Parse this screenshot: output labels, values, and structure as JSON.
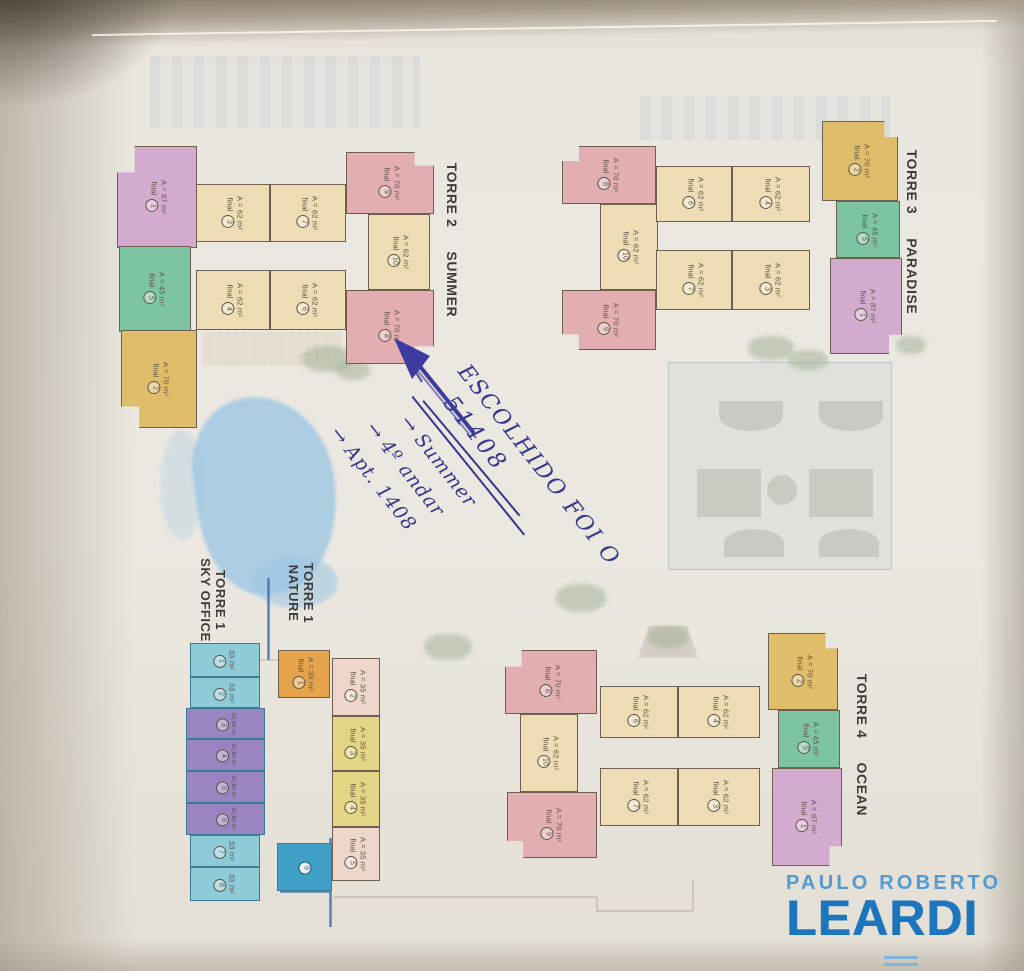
{
  "plan": {
    "unit_final_word": "final",
    "towers": [
      {
        "id": "torre-2",
        "label": "TORRE 2",
        "name": "SUMMER",
        "label_pos": {
          "cx": 452,
          "cy": 240,
          "stack": false
        },
        "units": [
          {
            "final": "1",
            "area": "A = 87 m²",
            "type": "purple",
            "x": 117,
            "y": 146,
            "w": 80,
            "h": 102,
            "clip": "polygon(22% 0,100% 0,100% 100%,0 100%,0 26%,22% 26%)"
          },
          {
            "final": "5",
            "area": "A = 45 m²",
            "type": "green",
            "x": 119,
            "y": 246,
            "w": 72,
            "h": 86
          },
          {
            "final": "2",
            "area": "A = 70 m²",
            "type": "yellow",
            "x": 121,
            "y": 330,
            "w": 76,
            "h": 98,
            "clip": "polygon(0 0,100% 0,100% 100%,24% 100%,24% 78%,0 78%)"
          },
          {
            "final": "3",
            "area": "A = 62 m²",
            "type": "tan",
            "x": 196,
            "y": 184,
            "w": 74,
            "h": 58
          },
          {
            "final": "7",
            "area": "A = 62 m²",
            "type": "tan",
            "x": 270,
            "y": 184,
            "w": 76,
            "h": 58
          },
          {
            "final": "4",
            "area": "A = 62 m²",
            "type": "tan",
            "x": 196,
            "y": 270,
            "w": 74,
            "h": 60
          },
          {
            "final": "6",
            "area": "A = 62 m²",
            "type": "tan",
            "x": 270,
            "y": 270,
            "w": 76,
            "h": 60
          },
          {
            "final": "9",
            "area": "A = 70 m²",
            "type": "pink",
            "x": 346,
            "y": 152,
            "w": 88,
            "h": 62,
            "clip": "polygon(0 0,78% 0,78% 22%,100% 22%,100% 100%,0 100%)"
          },
          {
            "final": "10",
            "area": "A = 62 m²",
            "type": "tan",
            "x": 368,
            "y": 214,
            "w": 62,
            "h": 76
          },
          {
            "final": "8",
            "area": "A = 70 m²",
            "type": "pink",
            "x": 346,
            "y": 290,
            "w": 88,
            "h": 74,
            "clip": "polygon(0 0,100% 0,100% 76%,78% 76%,78% 100%,0 100%)"
          }
        ]
      },
      {
        "id": "torre-3",
        "label": "TORRE 3",
        "name": "PARADISE",
        "label_pos": {
          "cx": 912,
          "cy": 232,
          "stack": false
        },
        "units": [
          {
            "final": "8",
            "area": "A = 70 m²",
            "type": "pink",
            "x": 562,
            "y": 146,
            "w": 94,
            "h": 58,
            "clip": "polygon(18% 0,100% 0,100% 100%,0 100%,0 26%,18% 26%)"
          },
          {
            "final": "10",
            "area": "A = 62 m²",
            "type": "tan",
            "x": 600,
            "y": 204,
            "w": 58,
            "h": 86
          },
          {
            "final": "9",
            "area": "A = 70 m²",
            "type": "pink",
            "x": 562,
            "y": 290,
            "w": 94,
            "h": 60,
            "clip": "polygon(0 0,100% 0,100% 100%,18% 100%,18% 74%,0 74%)"
          },
          {
            "final": "6",
            "area": "A = 62 m²",
            "type": "tan",
            "x": 656,
            "y": 166,
            "w": 76,
            "h": 56
          },
          {
            "final": "4",
            "area": "A = 62 m²",
            "type": "tan",
            "x": 732,
            "y": 166,
            "w": 78,
            "h": 56
          },
          {
            "final": "7",
            "area": "A = 62 m²",
            "type": "tan",
            "x": 656,
            "y": 250,
            "w": 76,
            "h": 60
          },
          {
            "final": "3",
            "area": "A = 62 m²",
            "type": "tan",
            "x": 732,
            "y": 250,
            "w": 78,
            "h": 60
          },
          {
            "final": "2",
            "area": "A = 70 m²",
            "type": "yellow",
            "x": 822,
            "y": 121,
            "w": 76,
            "h": 80,
            "clip": "polygon(0 0,82% 0,82% 20%,100% 20%,100% 100%,0 100%)"
          },
          {
            "final": "5",
            "area": "A = 45 m²",
            "type": "green",
            "x": 836,
            "y": 201,
            "w": 64,
            "h": 57
          },
          {
            "final": "1",
            "area": "A = 87 m²",
            "type": "purple",
            "x": 830,
            "y": 258,
            "w": 72,
            "h": 96,
            "clip": "polygon(0 0,100% 0,100% 80%,82% 80%,82% 100%,0 100%)"
          }
        ]
      },
      {
        "id": "torre-4",
        "label": "TORRE 4",
        "name": "OCEAN",
        "label_pos": {
          "cx": 862,
          "cy": 745,
          "stack": false
        },
        "units": [
          {
            "final": "8",
            "area": "A = 70 m²",
            "type": "pink",
            "x": 505,
            "y": 650,
            "w": 92,
            "h": 64,
            "clip": "polygon(18% 0,100% 0,100% 100%,0 100%,0 26%,18% 26%)"
          },
          {
            "final": "10",
            "area": "A = 62 m²",
            "type": "tan",
            "x": 520,
            "y": 714,
            "w": 58,
            "h": 78
          },
          {
            "final": "9",
            "area": "A = 70 m²",
            "type": "pink",
            "x": 507,
            "y": 792,
            "w": 90,
            "h": 66,
            "clip": "polygon(0 0,100% 0,100% 100%,18% 100%,18% 74%,0 74%)"
          },
          {
            "final": "6",
            "area": "A = 62 m²",
            "type": "tan",
            "x": 600,
            "y": 686,
            "w": 78,
            "h": 52
          },
          {
            "final": "4",
            "area": "A = 62 m²",
            "type": "tan",
            "x": 678,
            "y": 686,
            "w": 82,
            "h": 52
          },
          {
            "final": "7",
            "area": "A = 62 m²",
            "type": "tan",
            "x": 600,
            "y": 768,
            "w": 78,
            "h": 58
          },
          {
            "final": "3",
            "area": "A = 62 m²",
            "type": "tan",
            "x": 678,
            "y": 768,
            "w": 82,
            "h": 58
          },
          {
            "final": "2",
            "area": "A = 70 m²",
            "type": "yellow",
            "x": 768,
            "y": 633,
            "w": 70,
            "h": 77,
            "clip": "polygon(0 0,82% 0,82% 20%,100% 20%,100% 100%,0 100%)"
          },
          {
            "final": "5",
            "area": "A = 45 m²",
            "type": "green",
            "x": 778,
            "y": 710,
            "w": 62,
            "h": 58
          },
          {
            "final": "1",
            "area": "A = 87 m²",
            "type": "purple",
            "x": 772,
            "y": 768,
            "w": 70,
            "h": 98,
            "clip": "polygon(0 0,100% 0,100% 80%,82% 80%,82% 100%,0 100%)"
          }
        ]
      },
      {
        "id": "torre-1-sky-office",
        "label": "TORRE 1",
        "name": "SKY OFFICE",
        "label_pos": {
          "cx": 212,
          "cy": 600,
          "stack": true
        },
        "units": [
          {
            "num": "1",
            "area": "33 m²",
            "type": "skyblue",
            "x": 190,
            "y": 643,
            "w": 70,
            "h": 34
          },
          {
            "num": "2",
            "area": "33 m²",
            "type": "skyblue",
            "x": 190,
            "y": 677,
            "w": 70,
            "h": 31
          },
          {
            "num": "3",
            "area": "35,86 m²",
            "type": "skypurple",
            "x": 186,
            "y": 708,
            "w": 79,
            "h": 31
          },
          {
            "num": "4",
            "area": "35,86 m²",
            "type": "skypurple",
            "x": 186,
            "y": 739,
            "w": 79,
            "h": 32
          },
          {
            "num": "5",
            "area": "35,86 m²",
            "type": "skypurple",
            "x": 186,
            "y": 771,
            "w": 79,
            "h": 32
          },
          {
            "num": "6",
            "area": "35,86 m²",
            "type": "skypurple",
            "x": 186,
            "y": 803,
            "w": 79,
            "h": 32
          },
          {
            "num": "7",
            "area": "33 m²",
            "type": "skyblue",
            "x": 190,
            "y": 835,
            "w": 70,
            "h": 32
          },
          {
            "num": "8",
            "area": "33 m²",
            "type": "skyblue",
            "x": 190,
            "y": 867,
            "w": 70,
            "h": 34
          }
        ]
      },
      {
        "id": "torre-1-nature",
        "label": "TORRE 1",
        "name": "NATURE",
        "label_pos": {
          "cx": 300,
          "cy": 593,
          "stack": true
        },
        "units": [
          {
            "final": "1",
            "area": "A = 35 m²",
            "type": "orange",
            "x": 278,
            "y": 650,
            "w": 52,
            "h": 48
          },
          {
            "final": "2",
            "area": "A = 35 m²",
            "type": "palepink",
            "x": 332,
            "y": 658,
            "w": 48,
            "h": 58
          },
          {
            "final": "3",
            "area": "A = 35 m²",
            "type": "paleyellow",
            "x": 332,
            "y": 716,
            "w": 48,
            "h": 55
          },
          {
            "final": "4",
            "area": "A = 35 m²",
            "type": "paleyellow",
            "x": 332,
            "y": 771,
            "w": 48,
            "h": 56
          },
          {
            "final": "5",
            "area": "A = 35 m²",
            "type": "palepink",
            "x": 332,
            "y": 827,
            "w": 48,
            "h": 54
          },
          {
            "num": "9",
            "area": "",
            "type": "deepblue",
            "x": 277,
            "y": 843,
            "w": 55,
            "h": 48
          }
        ]
      }
    ]
  },
  "annotation": {
    "line1": "ESCOLHIDO FOI O",
    "line2": "51408",
    "arrow_glyph": "→",
    "arrow1": "Summer",
    "arrow2": "4º andar",
    "arrow3": "Apt. 1408"
  },
  "logo": {
    "line1": "PAULO ROBERTO",
    "line2": "LEARDI"
  },
  "colors": {
    "pink": "#e2aeb2",
    "tan": "#eddcb4",
    "yellow": "#e0bd6b",
    "green": "#7cc4a2",
    "purple": "#d2abce",
    "skyblue": "#8ecbd9",
    "skypurple": "#9b84c2",
    "orange": "#e5a44b",
    "deepblue": "#3f9fc6",
    "palepink": "#eed6cb",
    "paleyellow": "#e4d584",
    "unit_border": "#6f5f50",
    "pen_ink": "#34378e",
    "plan_line_blue": "#3b6fad",
    "logo_light": "#549ad2",
    "logo_dark": "#1d76bd",
    "label_text": "#3b3b3b"
  }
}
